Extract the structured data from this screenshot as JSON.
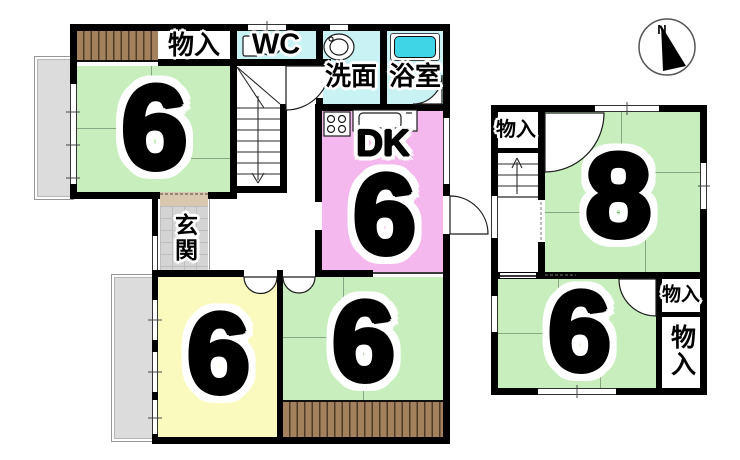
{
  "colors": {
    "wall_black": "#000000",
    "tatami_green": "#c8eebe",
    "dk_pink": "#f4b8ee",
    "room_yellow": "#fafabe",
    "wet_cyan": "#c9f2f4",
    "tub_cyan": "#3fd4e6",
    "closet_brown": "#a3815c",
    "closet_stripe": "#4e3b28",
    "veranda_gray": "#dcdcdc",
    "genkan_tile": "#d4d4d4",
    "genkan_step": "#d9c7ae"
  },
  "compass": {
    "north_label": "N"
  },
  "f1": {
    "room_nw": {
      "label": "6"
    },
    "storage": {
      "label": "物入"
    },
    "wc": {
      "label": "WC"
    },
    "washroom": {
      "label": "洗面"
    },
    "bathroom": {
      "label": "浴室"
    },
    "dk": {
      "type_label": "DK",
      "label": "6"
    },
    "entrance": {
      "label": "玄関"
    },
    "room_sw": {
      "label": "6"
    },
    "room_s": {
      "label": "6"
    }
  },
  "f2": {
    "storage_nw": {
      "label": "物入"
    },
    "room_ne": {
      "label": "8"
    },
    "room_s": {
      "label": "6"
    },
    "storage_small": {
      "label": "物入"
    },
    "storage_large": {
      "label": "物入"
    }
  }
}
